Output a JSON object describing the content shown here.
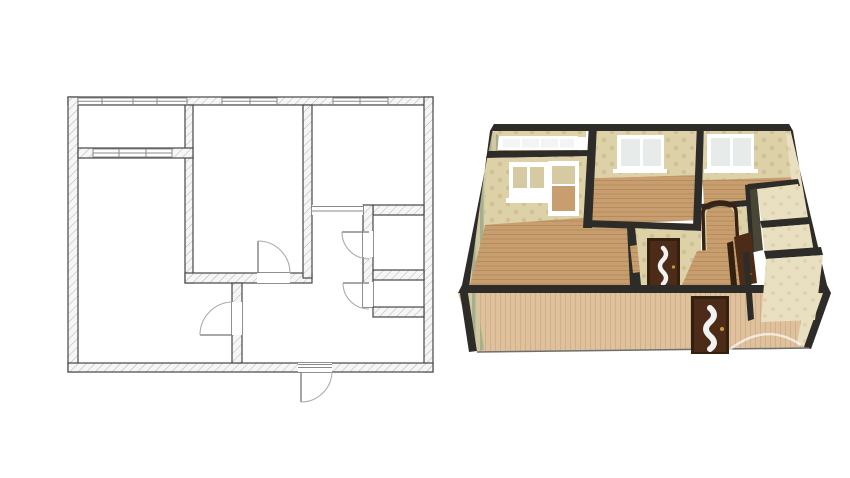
{
  "colors": {
    "page-bg": "#ffffff",
    "plan-wall-line": "#474747",
    "plan-hatch-line": "#b5b5b5",
    "plan-hatch-bg": "#f6f6f6",
    "plan-window-line": "#8a8a8a",
    "plan-door-arc": "#ababab",
    "plan-door-leaf": "#757575",
    "wall-top": "#2e2c29",
    "wallpaper-base": "#ddd1a8",
    "wallpaper-motif": "#bdab7c",
    "wallpaper-light": "#e9e0c2",
    "wallpaper-light-motif": "#cfc194",
    "stripe-a": "#cfc8a2",
    "stripe-b": "#a6ae8c",
    "wood-floor": "#c89e6e",
    "wood-floor-line": "#b1875a",
    "wood-apron": "#dfc29d",
    "wood-apron-line": "#cdad82",
    "window-frame": "#ffffff",
    "window-glass": "#e7eceb",
    "balcony-pane": "#d6caa3",
    "door-brown": "#4c2b19",
    "door-brown-dark": "#33200f",
    "door-glass-insert": "#f2f2f2",
    "arch-brown": "#3a2212",
    "handle-gold": "#c99b3f",
    "wall-shadow-face": "#4a4636"
  }
}
